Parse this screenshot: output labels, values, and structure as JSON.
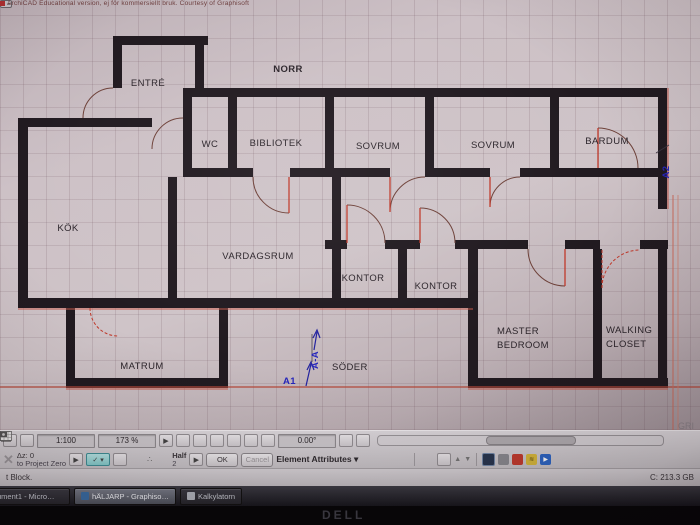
{
  "banner": {
    "text": "ArchiCAD Educational version, ej för kommersiellt bruk. Courtesy of Graphisoft"
  },
  "plan": {
    "labels": {
      "norr": "NORR",
      "entre": "ENTRÉ",
      "wc": "WC",
      "bibliotek": "BIBLIOTEK",
      "sovrum1": "SOVRUM",
      "sovrum2": "SOVRUM",
      "bardum": "BARDUM",
      "kok": "KÖK",
      "vardagsrum": "VARDAGSRUM",
      "kontor1": "KONTOR",
      "kontor2": "KONTOR",
      "master1": "MASTER",
      "master2": "BEDROOM",
      "closet1": "WALKING",
      "closet2": "CLOSET",
      "matrum": "MATRUM",
      "soder": "SÖDER",
      "a1": "A1",
      "aa": "A-A",
      "a2": "A2",
      "gri": "GRI"
    }
  },
  "toolbar": {
    "scale": "1:100",
    "zoom_percent": "173 %",
    "angle": "0.00°",
    "delta_z": "Δz: 0",
    "reference": "to Project Zero",
    "half_label": "Half",
    "half_value": "2",
    "ok": "OK",
    "cancel": "Cancel",
    "element_attributes": "Element Attributes"
  },
  "statusbar": {
    "left": "t Block.",
    "disk": "C: 213.3 GB"
  },
  "taskbar": {
    "items": [
      {
        "label": "ument1 - Micro…"
      },
      {
        "label": "hÄLJARP - Graphiso…"
      },
      {
        "label": "Kalkylatorn"
      }
    ]
  },
  "monitor": {
    "brand": "DELL"
  },
  "colors": {
    "wall": "#211a20",
    "accent_red": "#c0392b",
    "marker_blue": "#2626bb",
    "teal_button": "#84cccc"
  }
}
